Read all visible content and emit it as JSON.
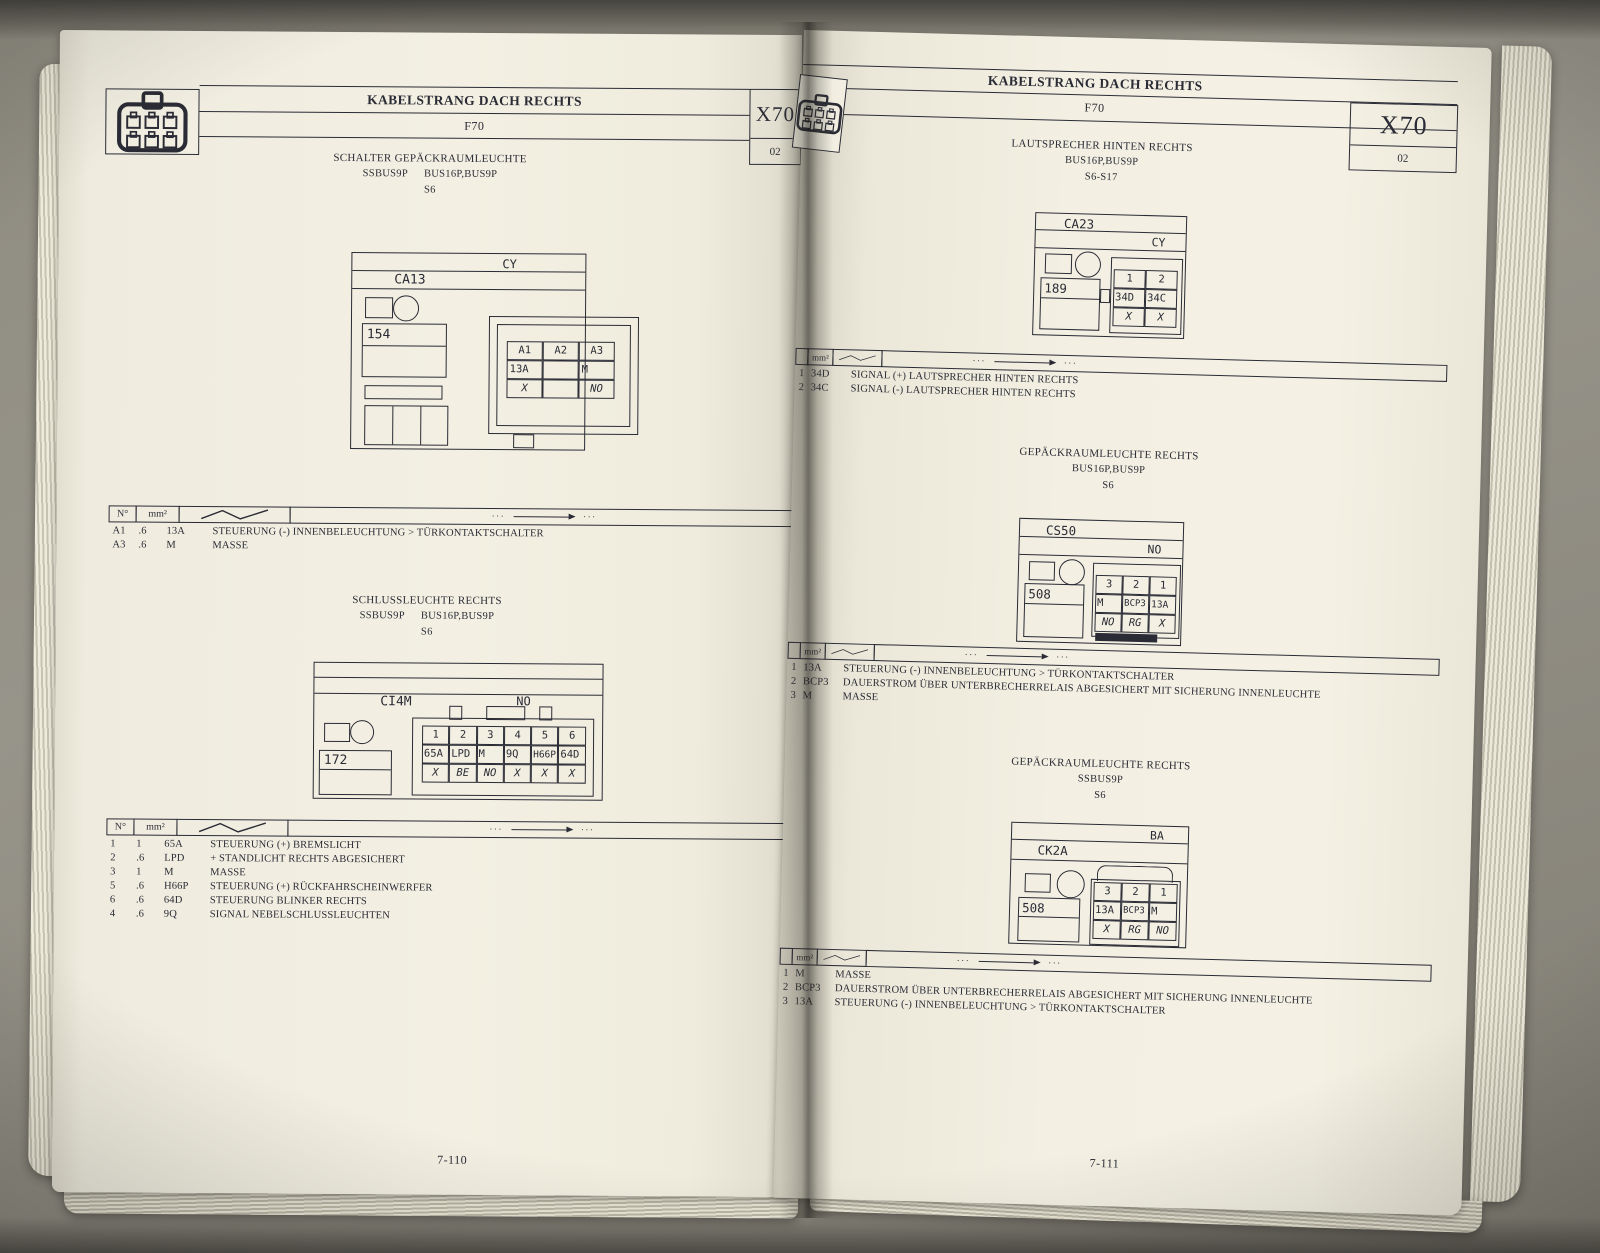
{
  "book": {
    "left_page": {
      "header": {
        "title": "KABELSTRANG DACH RECHTS",
        "code": "F70",
        "sheet": "X70",
        "sheet_num": "02"
      },
      "s1": {
        "title": "SCHALTER GEPÄCKRAUMLEUCHTE",
        "bus_a": "SSBUS9P",
        "bus_b": "BUS16P,BUS9P",
        "ref": "S6"
      },
      "d1": {
        "conn": "CA13",
        "zone": "CY",
        "comp": "154",
        "grid": {
          "r1": [
            "A1",
            "A2",
            "A3"
          ],
          "r2": [
            "13A",
            "",
            "M"
          ],
          "r3": [
            "X",
            "",
            "NO"
          ]
        }
      },
      "t1": {
        "h_no": "N°",
        "h_mm": "mm²",
        "dots": "···",
        "rows": [
          {
            "no": "A1",
            "mm": ".6",
            "code": "13A",
            "desc": "STEUERUNG (-) INNENBELEUCHTUNG > TÜRKONTAKTSCHALTER"
          },
          {
            "no": "A3",
            "mm": ".6",
            "code": "M",
            "desc": "MASSE"
          }
        ]
      },
      "s2": {
        "title": "SCHLUSSLEUCHTE RECHTS",
        "bus_a": "SSBUS9P",
        "bus_b": "BUS16P,BUS9P",
        "ref": "S6"
      },
      "d2": {
        "conn": "CI4M",
        "zone": "NO",
        "comp": "172",
        "grid": {
          "r1": [
            "1",
            "2",
            "3",
            "4",
            "5",
            "6"
          ],
          "r2": [
            "65A",
            "LPD",
            "M",
            "9Q",
            "H66P",
            "64D"
          ],
          "r3": [
            "X",
            "BE",
            "NO",
            "X",
            "X",
            "X"
          ]
        }
      },
      "t2": {
        "h_no": "N°",
        "h_mm": "mm²",
        "dots": "···",
        "rows": [
          {
            "no": "1",
            "mm": "1",
            "code": "65A",
            "desc": "STEUERUNG (+) BREMSLICHT"
          },
          {
            "no": "2",
            "mm": ".6",
            "code": "LPD",
            "desc": "+ STANDLICHT RECHTS ABGESICHERT"
          },
          {
            "no": "3",
            "mm": "1",
            "code": "M",
            "desc": "MASSE"
          },
          {
            "no": "5",
            "mm": ".6",
            "code": "H66P",
            "desc": "STEUERUNG (+) RÜCKFAHRSCHEINWERFER"
          },
          {
            "no": "6",
            "mm": ".6",
            "code": "64D",
            "desc": "STEUERUNG BLINKER RECHTS"
          },
          {
            "no": "4",
            "mm": ".6",
            "code": "9Q",
            "desc": "SIGNAL NEBELSCHLUSSLEUCHTEN"
          }
        ]
      },
      "page_number": "7-110"
    },
    "right_page": {
      "header": {
        "title": "KABELSTRANG DACH RECHTS",
        "code": "F70",
        "sheet": "X70",
        "sheet_num": "02"
      },
      "s1": {
        "title": "LAUTSPRECHER HINTEN RECHTS",
        "bus": "BUS16P,BUS9P",
        "ref": "S6-S17"
      },
      "d1": {
        "conn": "CA23",
        "zone": "CY",
        "comp": "189",
        "grid": {
          "r1": [
            "1",
            "2"
          ],
          "r2": [
            "34D",
            "34C"
          ],
          "r3": [
            "X",
            "X"
          ]
        }
      },
      "t1": {
        "h_mm": "mm²",
        "dots": "···",
        "rows": [
          {
            "no": "1",
            "code": "34D",
            "desc": "SIGNAL (+) LAUTSPRECHER HINTEN RECHTS"
          },
          {
            "no": "2",
            "code": "34C",
            "desc": "SIGNAL (-) LAUTSPRECHER HINTEN RECHTS"
          }
        ]
      },
      "s2": {
        "title": "GEPÄCKRAUMLEUCHTE RECHTS",
        "bus": "BUS16P,BUS9P",
        "ref": "S6"
      },
      "d2": {
        "conn": "CS50",
        "zone": "NO",
        "comp": "508",
        "grid": {
          "r1": [
            "3",
            "2",
            "1"
          ],
          "r2": [
            "M",
            "BCP3",
            "13A"
          ],
          "r3": [
            "NO",
            "RG",
            "X"
          ]
        }
      },
      "t2": {
        "h_mm": "mm²",
        "dots": "···",
        "rows": [
          {
            "no": "1",
            "code": "13A",
            "desc": "STEUERUNG (-) INNENBELEUCHTUNG > TÜRKONTAKTSCHALTER"
          },
          {
            "no": "2",
            "code": "BCP3",
            "desc": "DAUERSTROM ÜBER UNTERBRECHERRELAIS ABGESICHERT MIT SICHERUNG INNENLEUCHTE"
          },
          {
            "no": "3",
            "code": "M",
            "desc": "MASSE"
          }
        ]
      },
      "s3": {
        "title": "GEPÄCKRAUMLEUCHTE RECHTS",
        "bus": "SSBUS9P",
        "ref": "S6"
      },
      "d3": {
        "conn": "CK2A",
        "zone": "BA",
        "comp": "508",
        "grid": {
          "r1": [
            "3",
            "2",
            "1"
          ],
          "r2": [
            "13A",
            "BCP3",
            "M"
          ],
          "r3": [
            "X",
            "RG",
            "NO"
          ]
        }
      },
      "t3": {
        "h_mm": "mm²",
        "dots": "···",
        "rows": [
          {
            "no": "1",
            "code": "M",
            "desc": "MASSE"
          },
          {
            "no": "2",
            "code": "BCP3",
            "desc": "DAUERSTROM ÜBER UNTERBRECHERRELAIS ABGESICHERT MIT SICHERUNG INNENLEUCHTE"
          },
          {
            "no": "3",
            "code": "13A",
            "desc": "STEUERUNG (-) INNENBELEUCHTUNG > TÜRKONTAKTSCHALTER"
          }
        ]
      },
      "page_number": "7-111"
    }
  }
}
